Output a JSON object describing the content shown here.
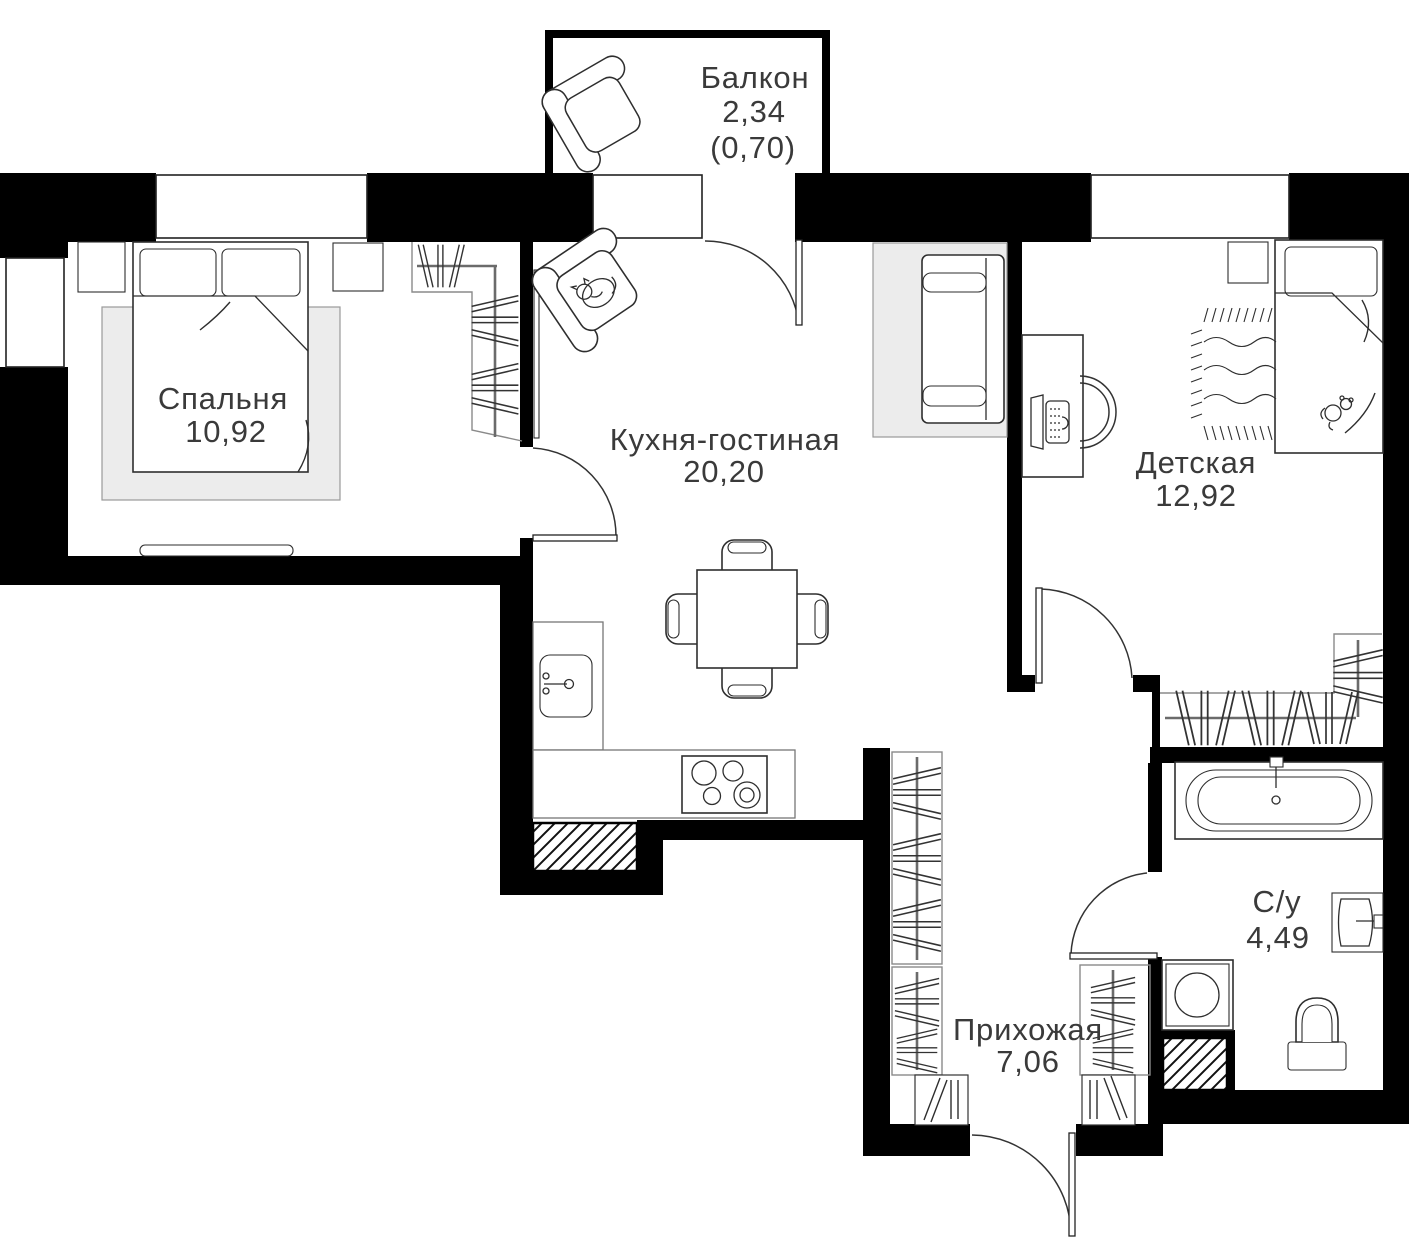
{
  "plan": {
    "type": "apartment-floor-plan",
    "colors": {
      "wall": "#000000",
      "furniture_line": "#2e2e2e",
      "soft_fill": "#ececec",
      "label": "#3a3a3a",
      "background": "#ffffff"
    },
    "rooms": [
      {
        "id": "balcony",
        "name": "Балкон",
        "area": "2,34",
        "area_reduced": "(0,70)"
      },
      {
        "id": "bedroom",
        "name": "Спальня",
        "area": "10,92"
      },
      {
        "id": "kitchen",
        "name": "Кухня-гостиная",
        "area": "20,20"
      },
      {
        "id": "children",
        "name": "Детская",
        "area": "12,92"
      },
      {
        "id": "bathroom",
        "name": "С/у",
        "area": "4,49"
      },
      {
        "id": "hallway",
        "name": "Прихожая",
        "area": "7,06"
      }
    ]
  }
}
